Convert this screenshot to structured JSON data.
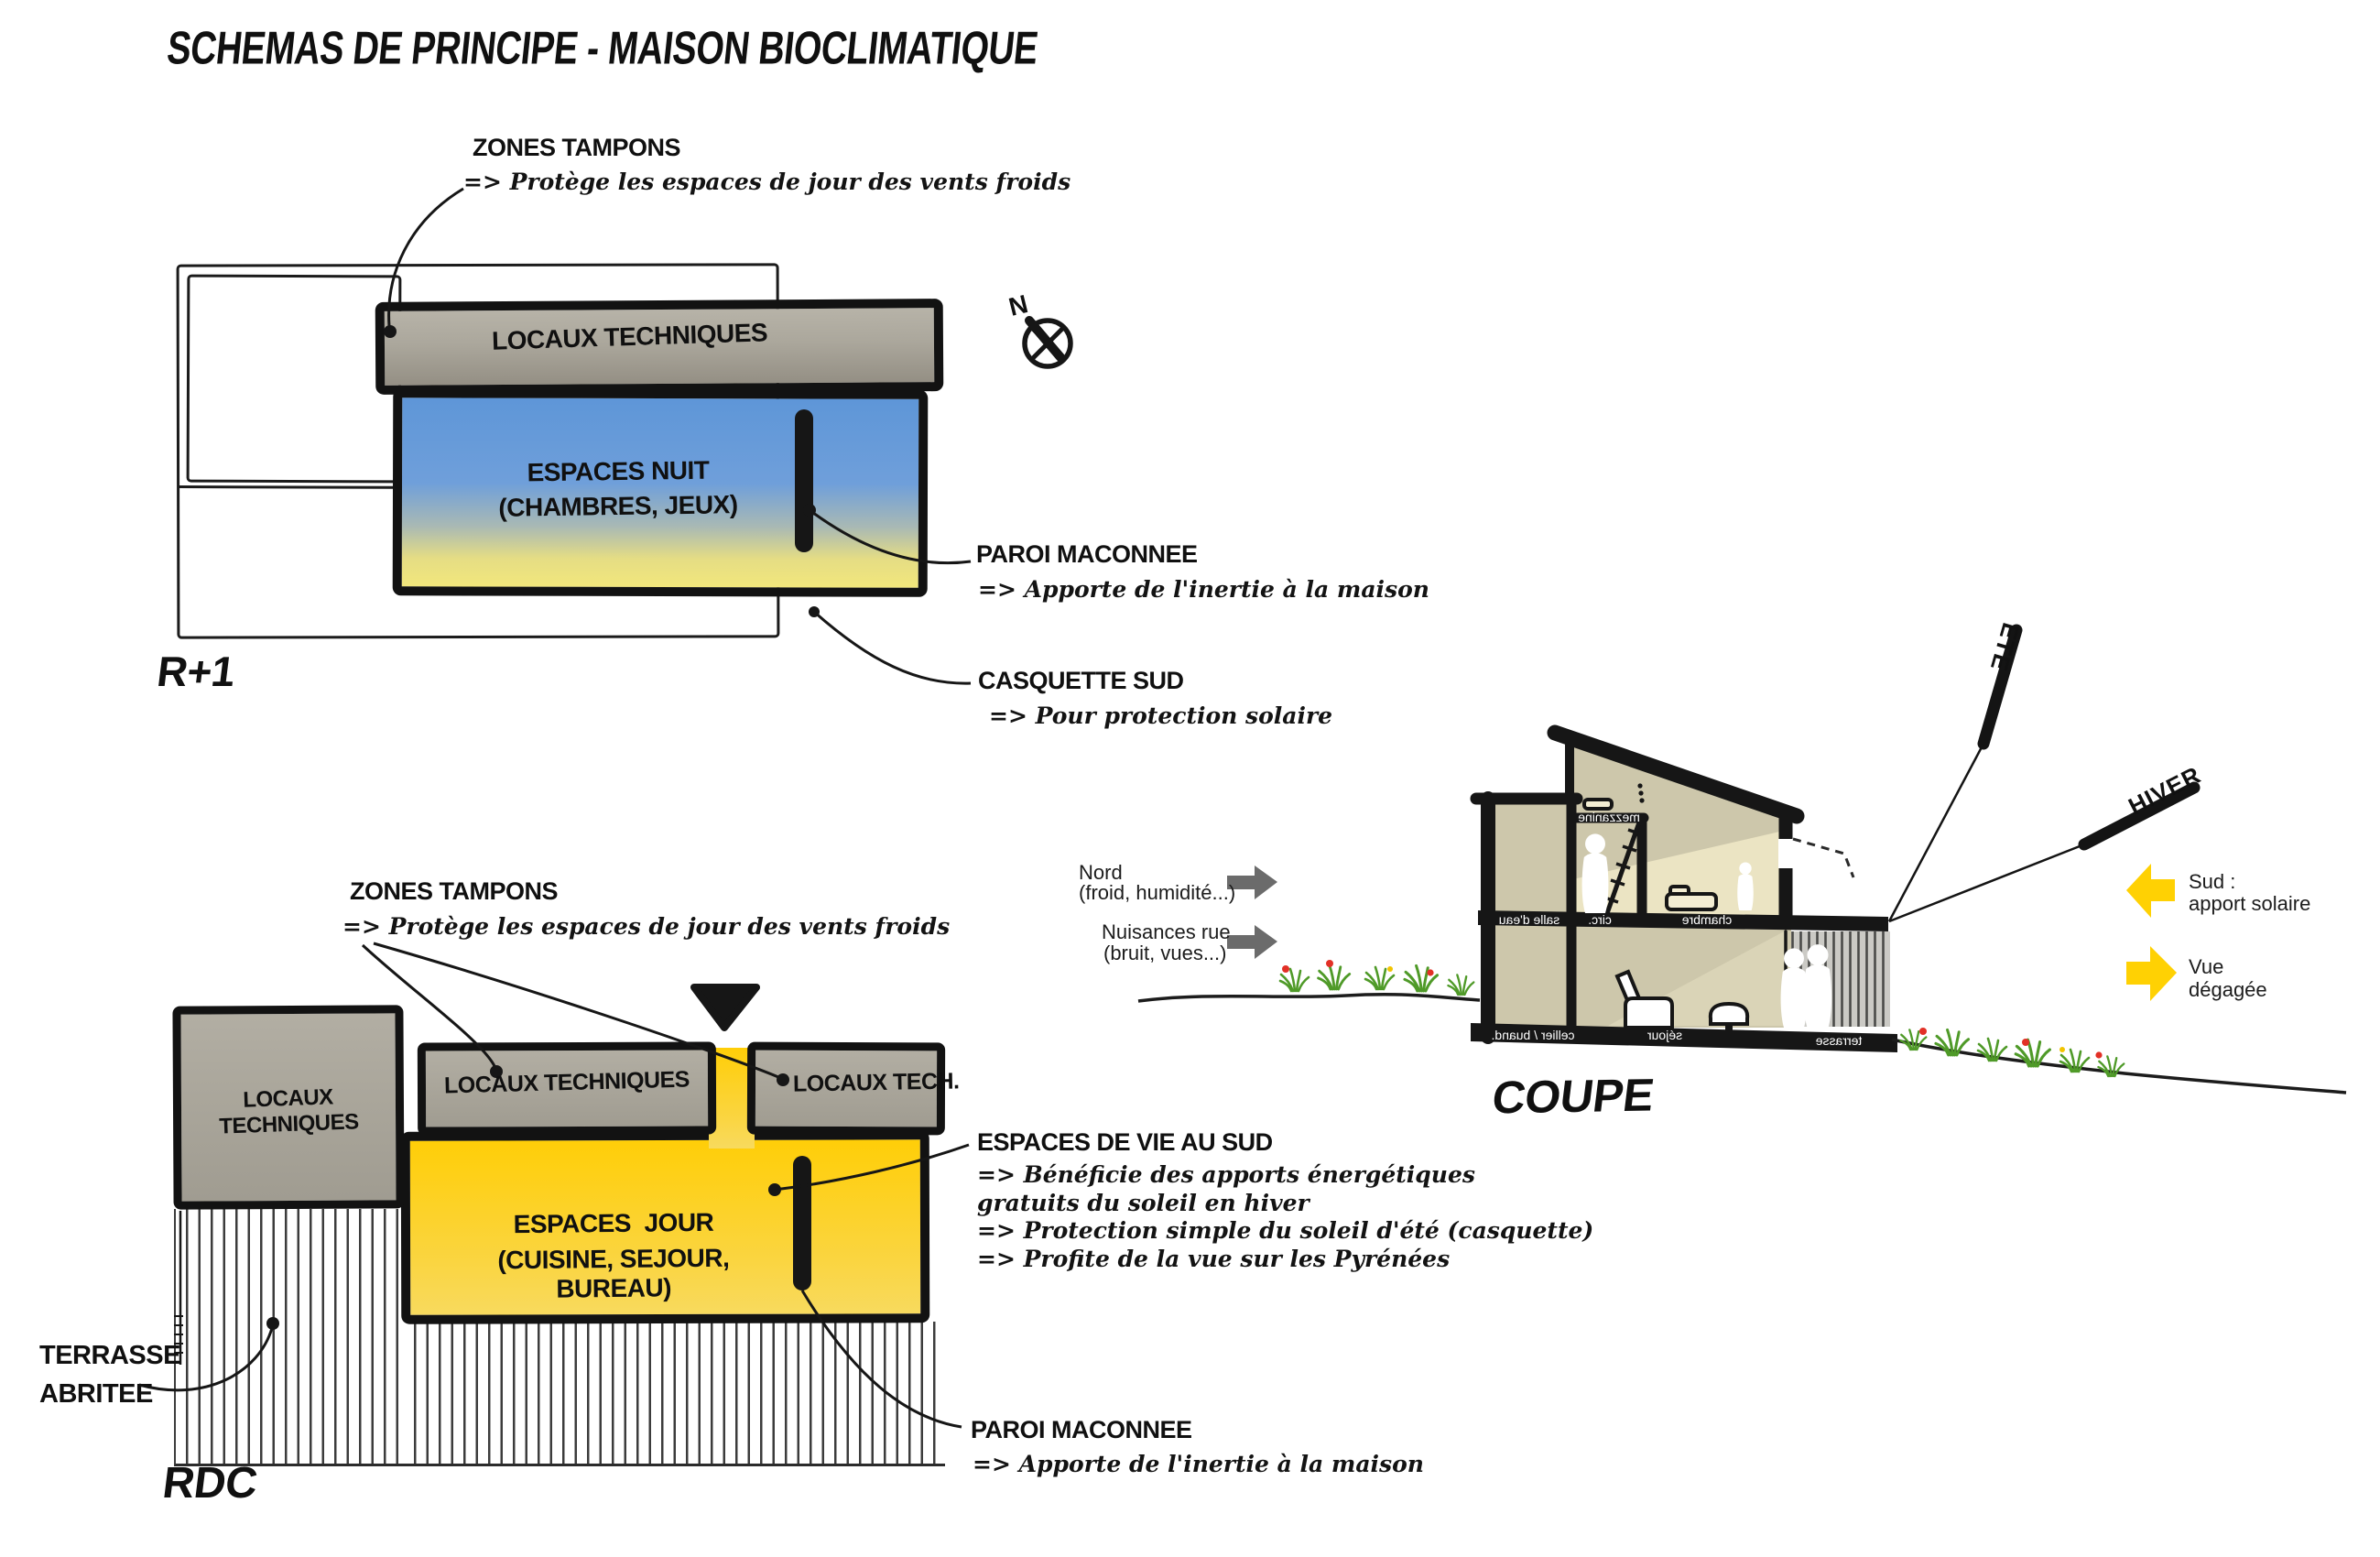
{
  "title": "SCHEMAS DE PRINCIPE - MAISON BIOCLIMATIQUE",
  "compass": {
    "label": "N"
  },
  "plans": {
    "r1": {
      "label": "R+1",
      "band_label": "LOCAUX TECHNIQUES",
      "room_line1": "ESPACES NUIT",
      "room_line2": "(CHAMBRES, JEUX)"
    },
    "rdc": {
      "label": "RDC",
      "box_left_label": "LOCAUX TECHNIQUES",
      "box_mid_label": "LOCAUX TECHNIQUES",
      "box_right_label": "LOCAUX TECH.",
      "room_line1": "ESPACES  JOUR",
      "room_line2": "(CUISINE, SEJOUR, BUREAU)",
      "terrace_line1": "TERRASSE",
      "terrace_line2": "ABRITEE"
    }
  },
  "annotations": {
    "zones_tampons_r1": {
      "title": "ZONES TAMPONS",
      "body": "=> Protège les espaces de jour des vents froids"
    },
    "zones_tampons_rdc": {
      "title": "ZONES TAMPONS",
      "body": "=> Protège les espaces de jour des vents froids"
    },
    "paroi_r1": {
      "title": "PAROI MACONNEE",
      "body": "=> Apporte de l'inertie à la maison"
    },
    "casquette_sud": {
      "title": "CASQUETTE SUD",
      "body": "=> Pour protection solaire"
    },
    "espaces_vie": {
      "title": "ESPACES DE VIE AU SUD",
      "lines": [
        "=> Bénéficie des apports énergétiques",
        "gratuits du soleil en hiver",
        "=> Protection simple du soleil d'été (casquette)",
        "=> Profite de la vue sur les Pyrénées"
      ]
    },
    "paroi_rdc": {
      "title": "PAROI MACONNEE",
      "body": "=> Apporte de l'inertie à la maison"
    }
  },
  "coupe": {
    "label": "COUPE",
    "rooms": {
      "mezzanine": "mezzanine",
      "salle_eau": "salle d'eau",
      "circ": "circ.",
      "chambre": "chambre",
      "cellier": "cellier / buand.",
      "sejour": "séjour",
      "terrasse": "terrasse"
    },
    "sun": {
      "ete": "ETE",
      "hiver": "HIVER"
    },
    "callouts": {
      "nord": {
        "line1": "Nord",
        "line2": "(froid, humidité...)"
      },
      "nuisances": {
        "line1": "Nuisances rue",
        "line2": "(bruit, vues...)"
      },
      "sud": {
        "line1": "Sud :",
        "line2": "apport solaire"
      },
      "vue": {
        "line1": "Vue",
        "line2": "dégagée"
      }
    }
  },
  "colors": {
    "night_blue": "#5E96D8",
    "day_yellow": "#FFD014",
    "tech_gray": "#ABA79C",
    "arrow_gray": "#6B6B6B",
    "arrow_yellow": "#FFD103"
  }
}
